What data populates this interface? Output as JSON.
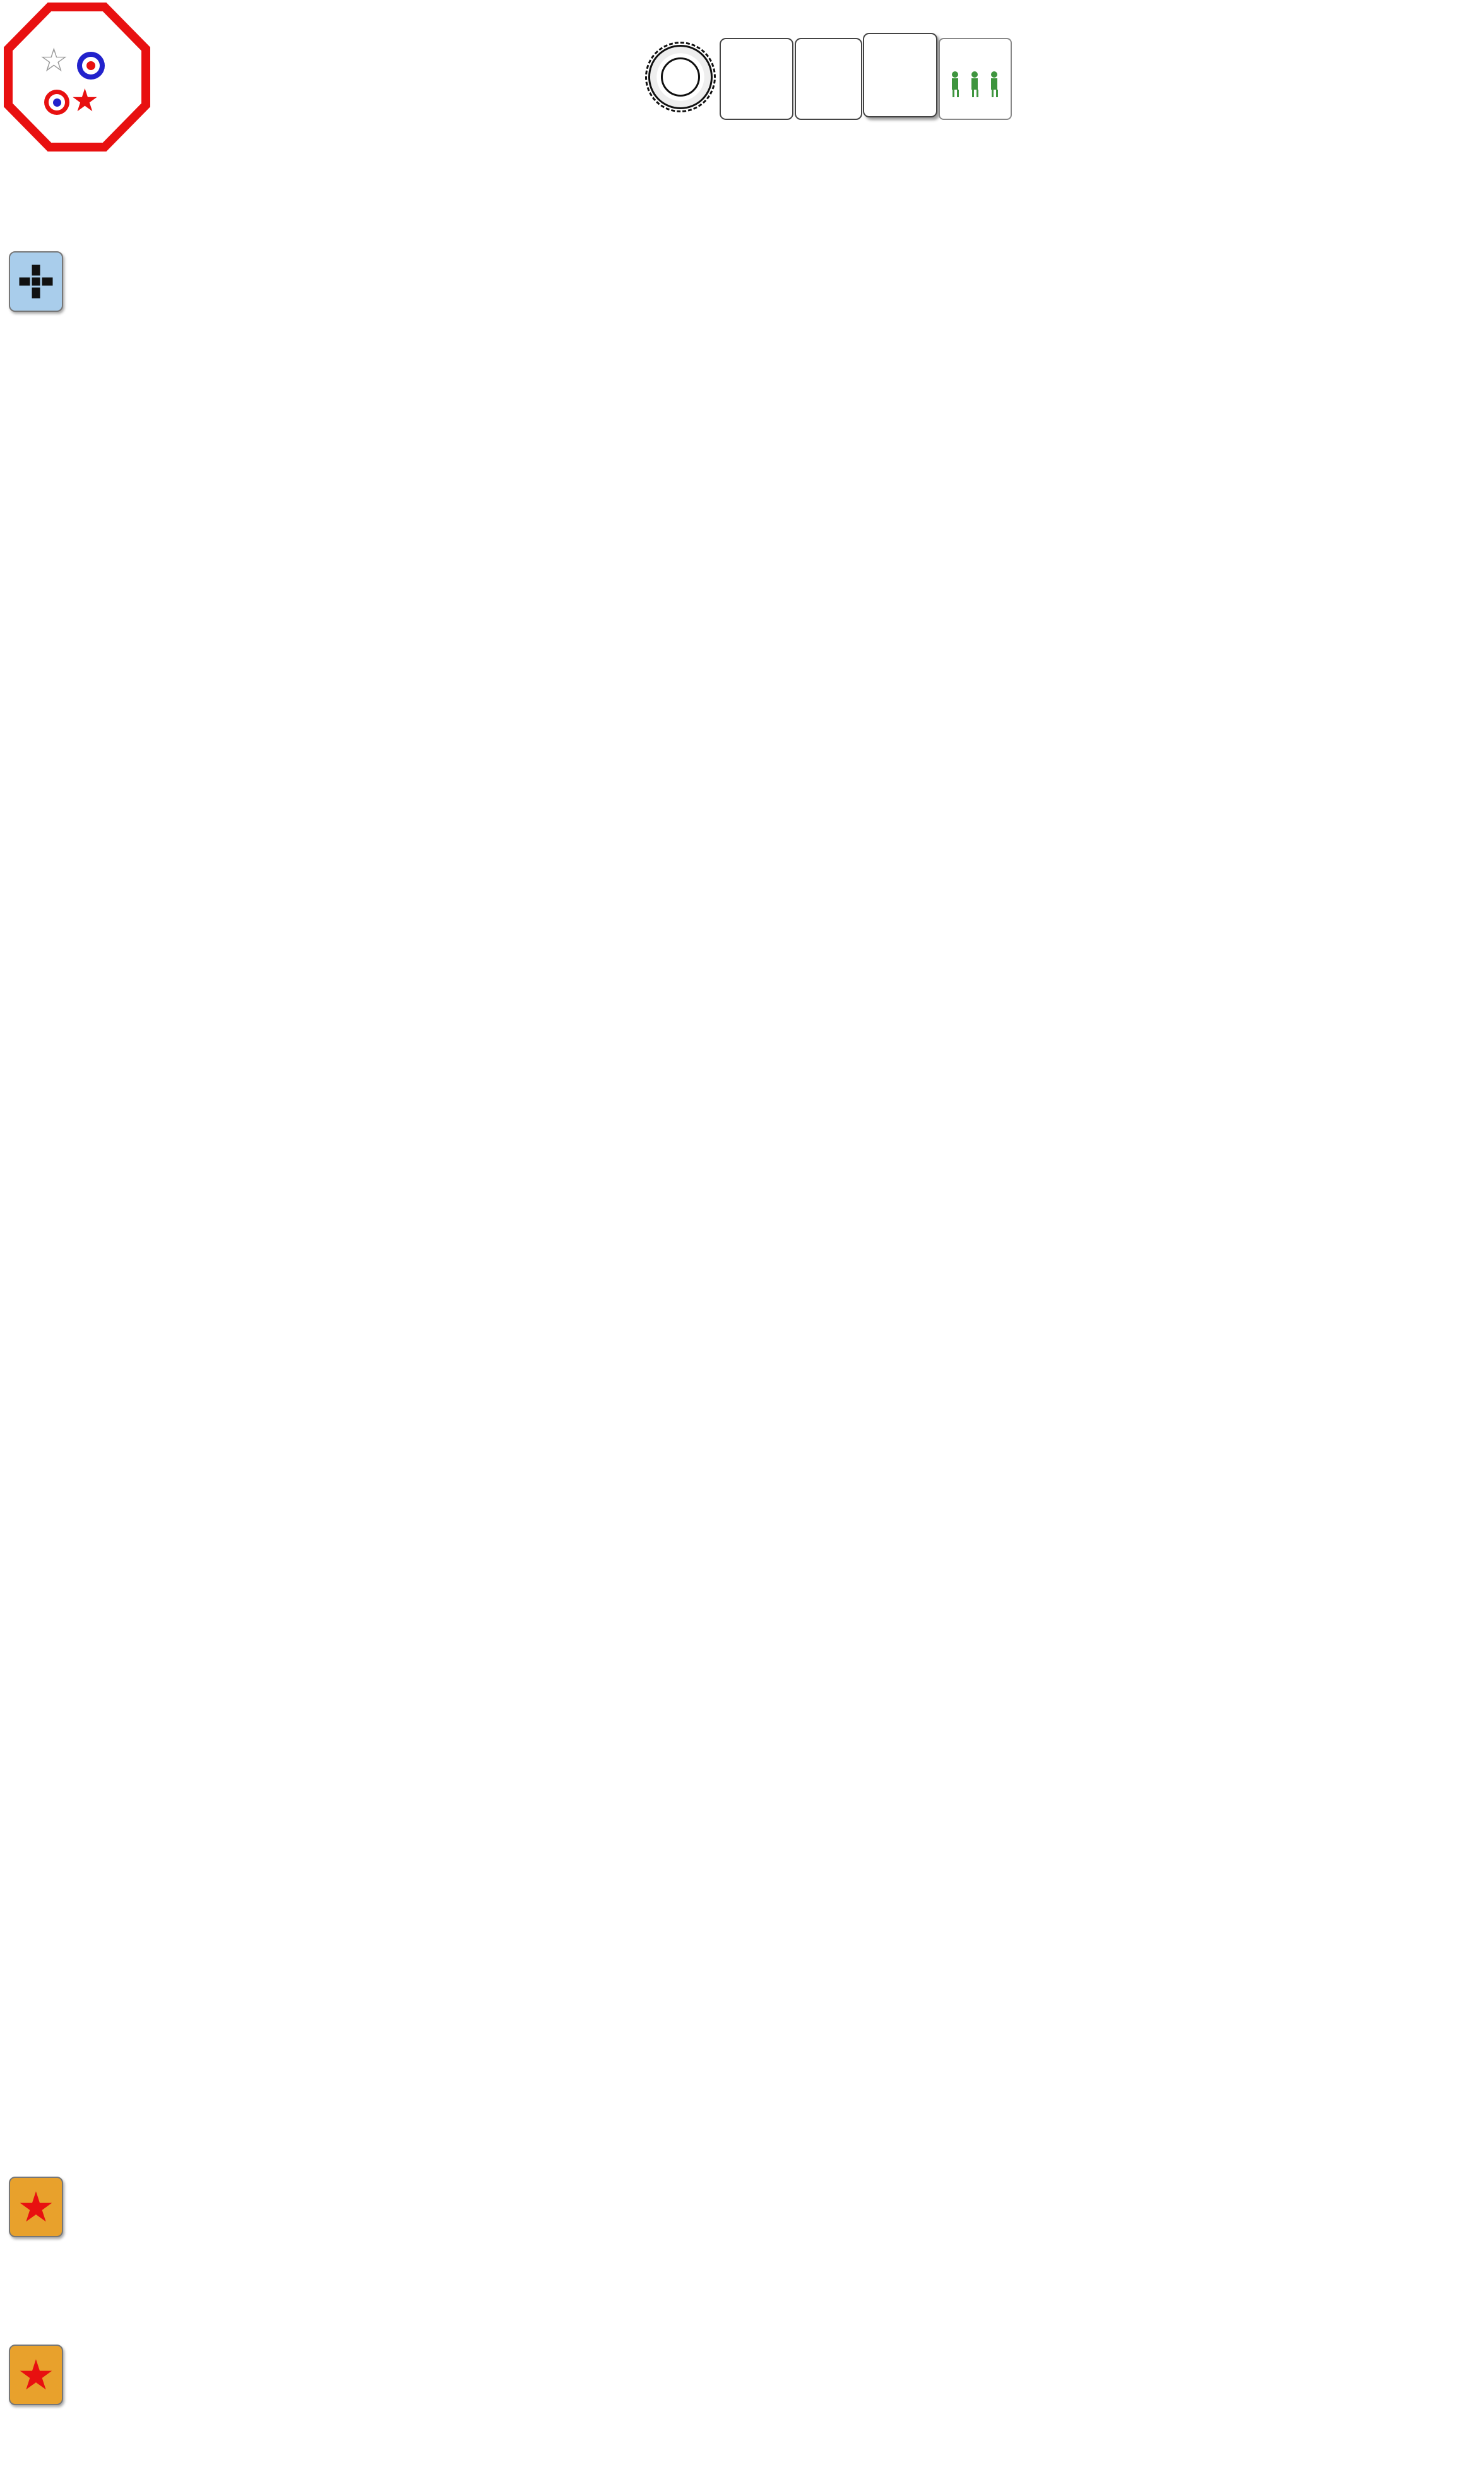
{
  "header": {
    "title": "THE STREETS OF KHARKOV (DB092)",
    "subtitle": "Kharkov, Russia, 13. March 1943",
    "roar": "ROAR (06/2025) Russian 26 / German 36 / Ext.Rt. 6.86",
    "created": "created with VASSAL v3.7.16 and VASL v6.6.10 on 4. June 2025"
  },
  "phase_wheel": {
    "phases": [
      "RPh",
      "PFPh",
      "MPh",
      "DFPh",
      "RtPh",
      "APh",
      "CCPh",
      "AFPh"
    ]
  },
  "turn_track": {
    "cells": [
      "1",
      "2",
      "3",
      "4",
      "5",
      "6",
      "END"
    ],
    "current_sub": "ALLIED",
    "compass": "Z",
    "compass_chevrons": "»"
  },
  "status": {
    "wet1": "Wet",
    "wet2": "EC: -2",
    "wind1": "No",
    "wind2": "Wind",
    "gusts1": "No",
    "gusts2": "Gusts",
    "nq1": "NO",
    "nq2": "Quarter",
    "nq3": "Declared",
    "nq_star": "★",
    "nq_cross": "✚"
  },
  "exit_vp": {
    "label": "German Exit VP (12 needed)",
    "value": "0",
    "minus": "–",
    "plus": "+"
  },
  "info_panels": [
    {
      "id": "spw",
      "side": "G",
      "label": "Info - SPW 251/1",
      "note": "CS 5"
    },
    {
      "id": "t34m41",
      "side": "R",
      "label": "Info - T-34 M41",
      "note": "Ⓡ *  CS 5  A4²/5³/6⁴"
    },
    {
      "id": "pzkw",
      "side": "G",
      "label": "Info - PzKw IVF2 (SS)",
      "note": "CS 6  sD6  s8  A5²/4³  Sz"
    },
    {
      "id": "marder",
      "side": "G",
      "label": "Info - Marder II (SS)",
      "note_red": "CS 4",
      "note": " s7  HE7  A6²/5³/4⁴"
    },
    {
      "id": "pak40",
      "side": "G",
      "label": "Info - PaK 40 (SS)",
      "note": "QSU  s7  A5²/4³/3⁴"
    },
    {
      "id": "t34m43",
      "side": "R",
      "label": "Info - T-34 M43",
      "note": "CS 5  A4²/5³/6⁴/7⁵"
    },
    {
      "id": "ptp",
      "side": "R",
      "label": "Info - PTP obr. 42",
      "note": "QSU  A4²/5³/6⁴/7⁵"
    }
  ],
  "info_counters": {
    "spw": {
      "kind": "veh",
      "side": "G",
      "veh": "ht",
      "mp": "16",
      "rightTop": "1",
      "right2": "1",
      "leftBox": "1",
      "gun": "15 PP",
      "gun2": "AAMG",
      "br": "T7",
      "br2": "-/-/3"
    },
    "t34m41": {
      "kind": "veh",
      "side": "R",
      "veh": "tank",
      "mp": "17",
      "mpRed": true,
      "rightCirc": [
        "11"
      ],
      "right2": "6",
      "gun": "76L",
      "br": "2/4",
      "ring": "square",
      "openBox": true
    },
    "pzkw": {
      "kind": "veh",
      "side": "G",
      "veh": "tank",
      "mp": "14",
      "rightTop": "6",
      "rightBox": "3",
      "leftBox": "1",
      "gun": "75L",
      "br": "3/5",
      "ring": "circle"
    },
    "marder": {
      "kind": "veh",
      "side": "G",
      "veh": "tank",
      "mp": "13",
      "rightCirc": [
        "3",
        "1"
      ],
      "leftBox": "1",
      "gun": "75L",
      "br": "★"
    },
    "pak40": {
      "kind": "gun",
      "side": "G",
      "top": "AT",
      "m": "M",
      "mcirc": "8",
      "leftBox": "2",
      "gun": "75L"
    },
    "t34m43": {
      "kind": "veh",
      "side": "R",
      "veh": "tank",
      "mp": "16",
      "rightTop": "11",
      "right2": "6",
      "leftBox": "1",
      "gun": "76L",
      "br": "2/4",
      "ring": "square"
    },
    "ptp": {
      "kind": "gun",
      "side": "R",
      "top": "AT",
      "m": "M",
      "mcirc": "11",
      "leftBox": "3",
      "gun": "45LL"
    }
  },
  "sections": [
    {
      "id": "german",
      "flag": "german-cross",
      "title": "Elements of SS-Panzergrenadier-Regiment 2, 1. SS-Panzergrenadier-Division \"Leibstandarte-SS Adolf Hitler\" [ELR: 5 / SAN: 3]",
      "subtitle": "Set up second on board 45 [EXC: Roadblocks may not set up in/adjacent to a bridge hex.].",
      "rows": [
        [
          {
            "kind": "squad",
            "side": "G",
            "stack": 3,
            "main": "6²5-8",
            "badge": "ss"
          },
          {
            "kind": "squad",
            "side": "G",
            "stack": 3,
            "main": "6²5-8",
            "badge": "ss"
          },
          {
            "kind": "squad",
            "side": "G",
            "stack": 3,
            "main": "6²5-8",
            "badge": "ss"
          },
          {
            "kind": "squad",
            "side": "G",
            "stack": 3,
            "main": "3-4-8",
            "badge": "ss"
          },
          {
            "kind": "squad",
            "side": "G",
            "main": "3-4-8",
            "badge": "ss"
          },
          {
            "kind": "leader",
            "side": "G",
            "name": "Löwitsch",
            "rating": "10-2"
          },
          {
            "kind": "leader",
            "side": "G",
            "name": "Hassler",
            "rating": "9-1"
          },
          {
            "kind": "leader",
            "side": "G",
            "name": "Czerny",
            "rating": "8-1"
          },
          {
            "kind": "leader",
            "side": "G",
            "name": "Brunner",
            "rating": "8-0"
          },
          {
            "kind": "sw",
            "side": "G",
            "type": "HMG",
            "pp": "4 PP",
            "box": "3",
            "main": "7-16",
            "icon": "mg"
          },
          {
            "kind": "sw",
            "side": "G",
            "stack": 3,
            "type": "LMG",
            "pp": "1 PP",
            "box": "1",
            "main": "3-8",
            "icon": "mg"
          },
          {
            "kind": "sw",
            "side": "G",
            "type": "LMG",
            "pp": "1 PP",
            "box": "1",
            "main": "3-8",
            "icon": "mg"
          },
          {
            "kind": "sw",
            "side": "G",
            "type": "DC",
            "pp": "1 PP",
            "extra": "△ X12",
            "main": "30-1",
            "icon": "dc"
          },
          {
            "kind": "sw",
            "side": "G",
            "type": "FT",
            "pp": "1 PP",
            "extra": "△ X10",
            "main": "24-1",
            "icon": "ft"
          }
        ],
        [
          {
            "tag": "A",
            "kind": "veh",
            "side": "G",
            "veh": "tank",
            "mp": "14",
            "rightTop": "6",
            "rightBox": "3",
            "leftBox": "1",
            "gun": "75L",
            "br": "3/5",
            "ring": "circle"
          },
          {
            "tag": "C",
            "kind": "veh",
            "side": "G",
            "veh": "tank",
            "mp": "13",
            "rightCirc": [
              "3",
              "1"
            ],
            "leftBox": "1",
            "gun": "75L",
            "br": "★"
          },
          {
            "tag": "E",
            "kind": "veh",
            "side": "G",
            "veh": "ht",
            "mp": "16",
            "rightTop": "1",
            "right2": "1",
            "leftBox": "1",
            "gun": "15 PP",
            "gun2": "AAMG",
            "br": "T7",
            "br2": "-/-/3"
          },
          {
            "tag": "F",
            "kind": "gun",
            "side": "G",
            "top": "AT",
            "m": "M",
            "mcirc": "8",
            "leftBox": "2",
            "gun": "75L"
          },
          {
            "kind": "crew",
            "side": "G",
            "main": "2-2-8"
          },
          {
            "kind": "leader",
            "side": "G",
            "name": "Krüger",
            "rating": "9-2"
          },
          {
            "kind": "conceal",
            "side": "G",
            "lines": [
              "Conceal-",
              "ment",
              "x4"
            ]
          },
          {
            "kind": "roadblock",
            "label": "Roadblock"
          },
          {
            "tag": "ELR: 5",
            "kind": "dice",
            "side": "G",
            "center": "3",
            "around": [
              "6",
              "1",
              "2",
              "5",
              "4",
              "3"
            ]
          }
        ]
      ]
    },
    {
      "id": "russian1",
      "flag": "red-star",
      "title": "Elements of the 3rd Tank Army [ELR: 3 / SAN: 4]",
      "subtitle": "Set up first on board 51 in hexes numbered less or equal to 2 [EXC: Roadblocks must set up on board 51 in hexes numbered less or equal to 8.]",
      "rows": [
        [
          {
            "kind": "squad",
            "side": "R",
            "stack": 3,
            "main": "5-2-7",
            "tr": "1"
          },
          {
            "kind": "squad",
            "side": "R",
            "stack": 3,
            "main": "4-4-7",
            "trBox": "1"
          },
          {
            "kind": "squad",
            "side": "R",
            "stack": 3,
            "main": "4-4-7",
            "trBox": "1"
          },
          {
            "kind": "crew",
            "side": "R",
            "main": "2-2-8"
          },
          {
            "kind": "leader",
            "side": "R",
            "name": "Kaputkin",
            "rating": "9-1"
          },
          {
            "kind": "leader",
            "side": "R",
            "name": "Oblomov",
            "rating": "7-0"
          },
          {
            "kind": "sw",
            "side": "R",
            "type": "MMG",
            "pp": "5 PP",
            "box": "2",
            "extra": "B11",
            "main": "4-10",
            "icon": "mg"
          },
          {
            "kind": "sw",
            "side": "R",
            "stack": 3,
            "type": "LMG",
            "pp": "1 PP",
            "box": "1",
            "extra": "B11",
            "main": "2-6",
            "icon": "mg"
          },
          {
            "kind": "sw",
            "side": "R",
            "stack": 2,
            "type": "ATR",
            "pp": "1 PP",
            "main": "1-12",
            "icon": "atr"
          },
          {
            "kind": "sw",
            "side": "R",
            "type": "DC",
            "pp": "1 PP",
            "extra": "△ X12",
            "main": "30-1",
            "icon": "dc"
          },
          {
            "tag": "80mm HE",
            "kind": "sw",
            "side": "R",
            "type": "Phone",
            "extra": "△ X12",
            "main": "11",
            "icon": "phone"
          },
          {
            "kind": "conceal",
            "side": "R",
            "lines": [
              "Conceal-",
              "ment",
              "x3"
            ]
          },
          {
            "tag": "A",
            "kind": "gun",
            "side": "R",
            "top": "AT",
            "m": "M",
            "mcirc": "11",
            "leftBox": "3",
            "gun": "45LL"
          },
          {
            "kind": "roadblock",
            "stack": 3,
            "label": "Roadblock"
          },
          {
            "kind": "sniper",
            "side": "R",
            "main": "-1"
          }
        ]
      ]
    },
    {
      "id": "russian2",
      "flag": "red-star",
      "title": "Elements of the Separate Combat Supplement Battalion, 17th NKVD Brigade [ELR: 5] and 179th Tank Brigade",
      "subtitle": "Set up last (third) on board 51 in hexes numbered greater or equal to 3.",
      "rows": [
        [
          {
            "kind": "squad",
            "side": "R",
            "stack": 3,
            "main": "6-2-8",
            "flag": true
          },
          {
            "kind": "squad",
            "side": "R",
            "stack": 3,
            "main": "6-2-8",
            "flag": true
          },
          {
            "kind": "squad",
            "side": "R",
            "stack": 3,
            "main": "6-2-8",
            "flag": true
          },
          {
            "kind": "leader",
            "side": "R",
            "name": "Kerenski",
            "rating": "10-0"
          },
          {
            "kind": "leader",
            "side": "R",
            "name": "Cherkov",
            "rating": "9-0"
          },
          {
            "kind": "sw",
            "side": "R",
            "stack": 3,
            "type": "LMG",
            "pp": "1 PP",
            "box": "1",
            "extra": "B11",
            "main": "2-6",
            "icon": "mg"
          },
          {
            "kind": "sw",
            "side": "R",
            "type": "DC",
            "pp": "1 PP",
            "extra": "△ X12",
            "main": "30-1",
            "icon": "dc"
          },
          {
            "tag": "B",
            "kind": "veh",
            "side": "R",
            "stack": 3,
            "veh": "tank",
            "mp": "16",
            "rightTop": "11",
            "right2": "6",
            "leftBox": "1",
            "gun": "76L",
            "br": "2/4",
            "ring": "square"
          },
          {
            "tag": "E",
            "kind": "veh",
            "side": "R",
            "veh": "tank",
            "mp": "16",
            "rightTop": "11",
            "right2": "6",
            "leftBox": "1",
            "gun": "76L",
            "br": "2/4",
            "ring": "square"
          },
          {
            "tag": "F",
            "kind": "veh",
            "side": "R",
            "stack": 2,
            "veh": "tank",
            "mp": "17",
            "mpRed": true,
            "rightCirc": [
              "11"
            ],
            "right2": "6",
            "gun": "76L",
            "br": "2/4",
            "ring": "square",
            "openBox": true
          },
          {
            "tag": "ELR: 3/5",
            "kind": "dice",
            "side": "R",
            "center": "4",
            "around": [
              "6",
              "1",
              "2",
              "5",
              "4",
              "3"
            ]
          },
          {
            "tag": "80mm HE",
            "kind": "dice",
            "side": "R",
            "center": "AR",
            "centerHex": true,
            "around": [
              "6",
              "1",
              "2",
              "5",
              "4",
              "3"
            ]
          },
          {
            "kind": "tile",
            "lines": [
              "No Contact",
              "No Access"
            ],
            "red": true,
            "split": true
          },
          {
            "kind": "tile",
            "lines": [
              "Pre-",
              "Reg"
            ],
            "red": true
          }
        ]
      ]
    }
  ],
  "map": {
    "board_number": "51",
    "deep_river": [
      "Deep",
      "River"
    ],
    "heavy_current": [
      "Heavy",
      "Current"
    ],
    "vse": "VSE",
    "factory_letter": "F",
    "hex_labels": {
      "top_row": [
        "FF10",
        "EE10",
        "DD10",
        "CC10",
        "BB10",
        "AA10",
        "Z10"
      ],
      "board45_row": [
        "FF1",
        "EE1",
        "DD1",
        "CC1",
        "BB1",
        "AA1",
        "Z1"
      ],
      "board51_row1": [
        "C1",
        "E1",
        "G1",
        "I1",
        "K1",
        "M1",
        "O1"
      ],
      "board51_row2": [
        "B1",
        "D1",
        "F1",
        "H1",
        "J1",
        "L1",
        "N1",
        "P1"
      ],
      "left_col": [
        "B2",
        "B3",
        "B4",
        "B5",
        "B6",
        "B7",
        "B8",
        "B9"
      ],
      "bottom_row": [
        "B10",
        "D10",
        "F10",
        "H10",
        "J10",
        "L10",
        "N10"
      ],
      "scatter": [
        "007",
        "Z5",
        "X4",
        "AA5",
        "U10",
        "S9"
      ]
    },
    "colors": {
      "grass": "#b5c47e",
      "river": "#a5cddf",
      "road": "#c9c9d2",
      "building": "#9b9b9b",
      "setup_line": "#e03020"
    }
  }
}
